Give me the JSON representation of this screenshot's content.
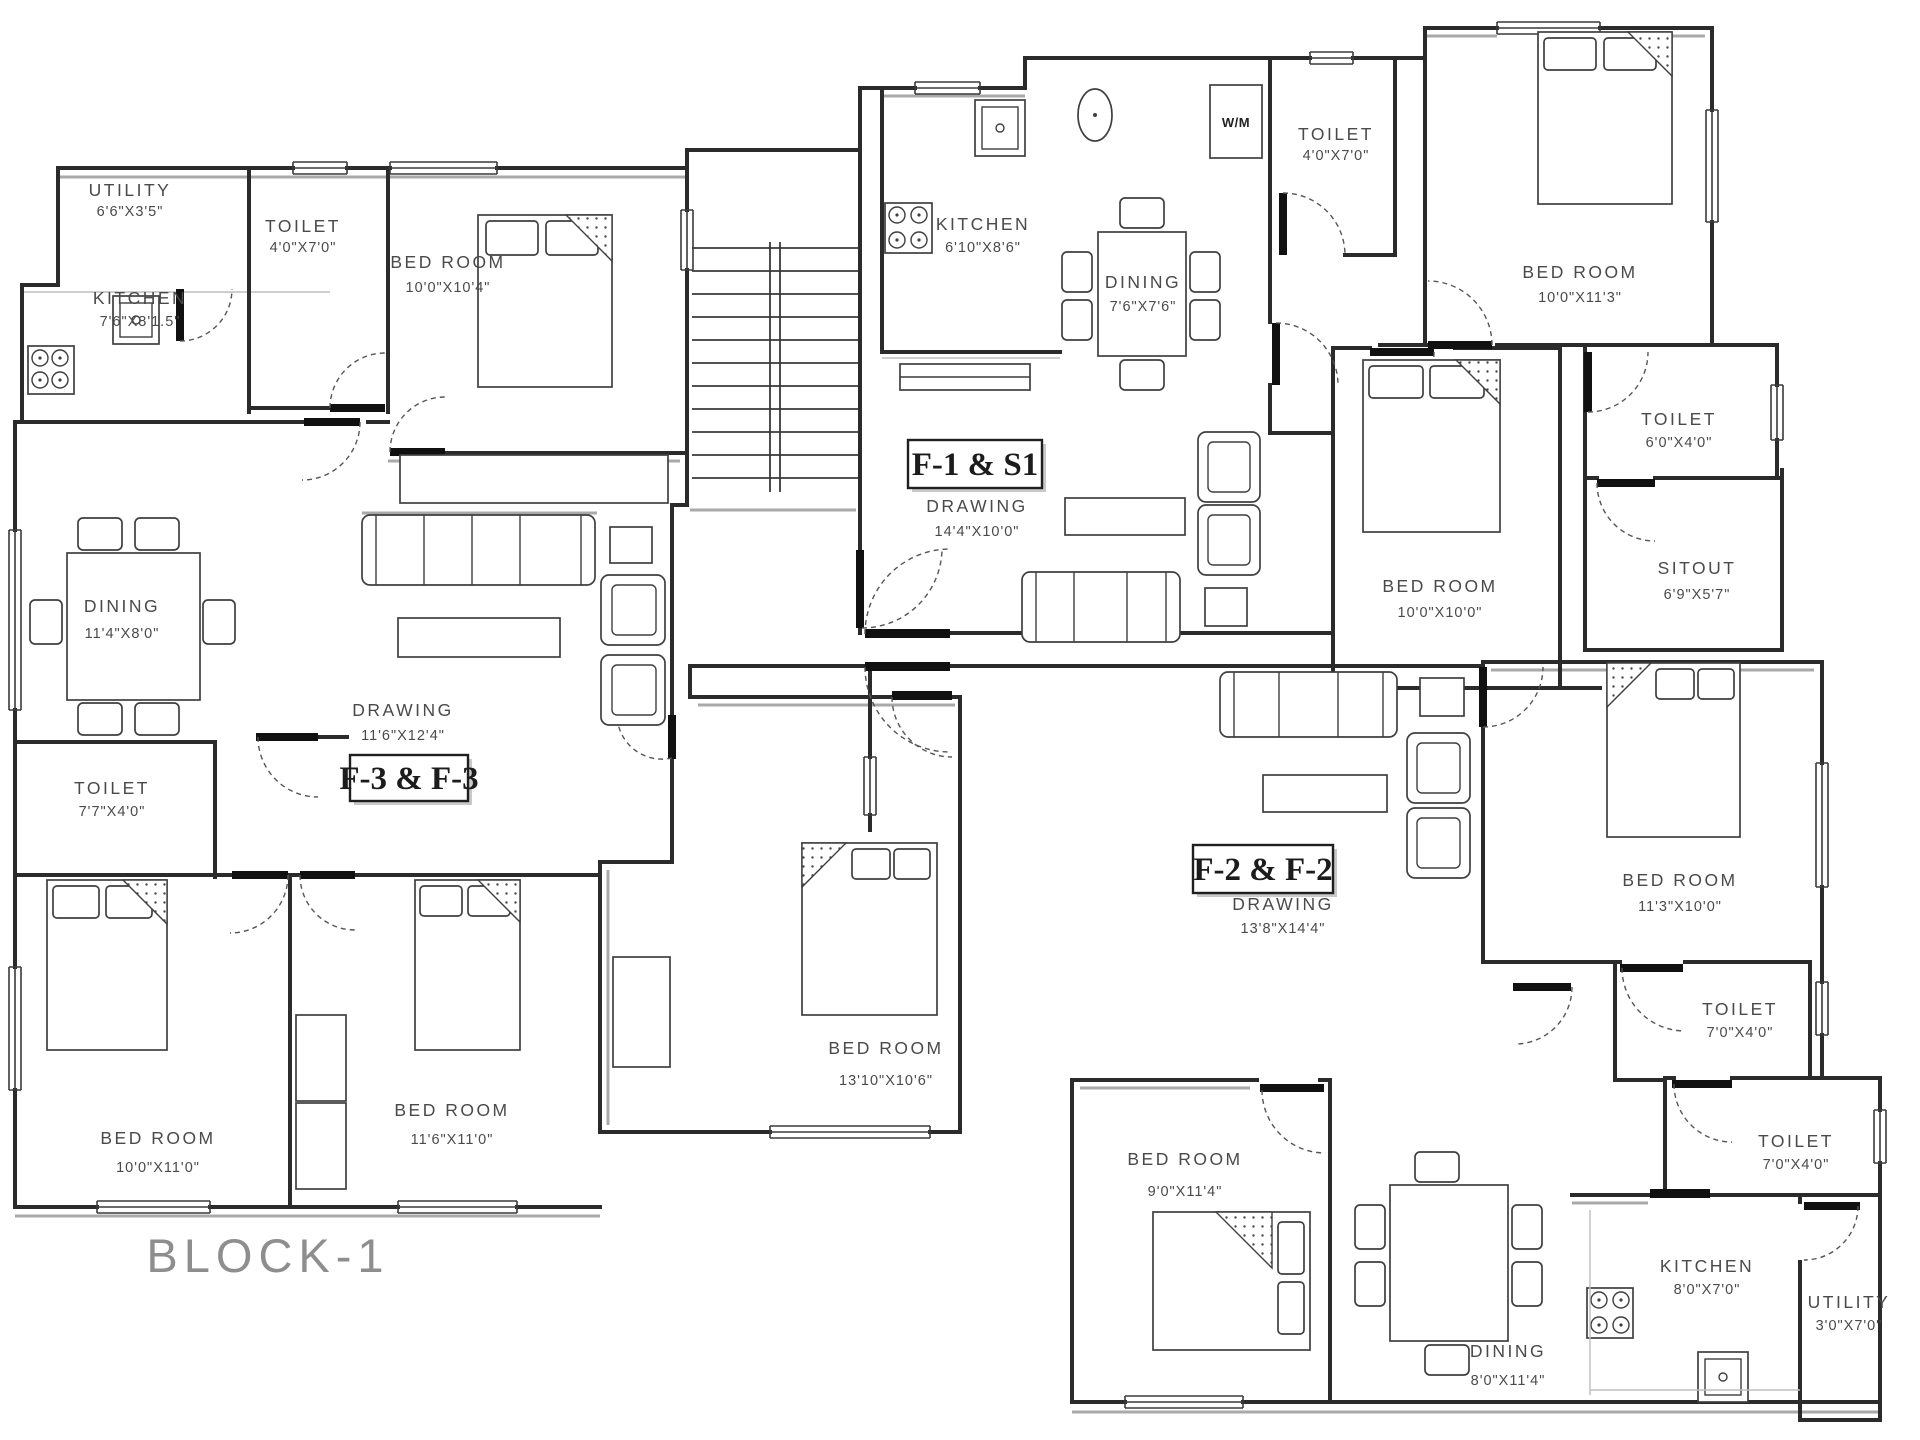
{
  "title": "BLOCK-1",
  "units": [
    {
      "label": "F-3 & F-3"
    },
    {
      "label": "F-1 & S1"
    },
    {
      "label": "F-2 & F-2"
    }
  ],
  "rooms": [
    {
      "name": "UTILITY",
      "dims": "6'6\"X3'5\""
    },
    {
      "name": "TOILET",
      "dims": "4'0\"X7'0\""
    },
    {
      "name": "BED ROOM",
      "dims": "10'0\"X10'4\""
    },
    {
      "name": "KITCHEN",
      "dims": "7'6\"X8'1.5\""
    },
    {
      "name": "DINING",
      "dims": "11'4\"X8'0\""
    },
    {
      "name": "DRAWING",
      "dims": "11'6\"X12'4\""
    },
    {
      "name": "TOILET",
      "dims": "7'7\"X4'0\""
    },
    {
      "name": "BED ROOM",
      "dims": "10'0\"X11'0\""
    },
    {
      "name": "BED ROOM",
      "dims": "11'6\"X11'0\""
    },
    {
      "name": "KITCHEN",
      "dims": "6'10\"X8'6\""
    },
    {
      "name": "DINING",
      "dims": "7'6\"X7'6\""
    },
    {
      "name": "TOILET",
      "dims": "4'0\"X7'0\""
    },
    {
      "name": "W/M",
      "dims": ""
    },
    {
      "name": "BED ROOM",
      "dims": "10'0\"X11'3\""
    },
    {
      "name": "DRAWING",
      "dims": "14'4\"X10'0\""
    },
    {
      "name": "BED ROOM",
      "dims": "10'0\"X10'0\""
    },
    {
      "name": "TOILET",
      "dims": "6'0\"X4'0\""
    },
    {
      "name": "SITOUT",
      "dims": "6'9\"X5'7\""
    },
    {
      "name": "DRAWING",
      "dims": "13'8\"X14'4\""
    },
    {
      "name": "BED ROOM",
      "dims": "11'3\"X10'0\""
    },
    {
      "name": "TOILET",
      "dims": "7'0\"X4'0\""
    },
    {
      "name": "TOILET",
      "dims": "7'0\"X4'0\""
    },
    {
      "name": "BED ROOM",
      "dims": "13'10\"X10'6\""
    },
    {
      "name": "BED ROOM",
      "dims": "9'0\"X11'4\""
    },
    {
      "name": "DINING",
      "dims": "8'0\"X11'4\""
    },
    {
      "name": "KITCHEN",
      "dims": "8'0\"X7'0\""
    },
    {
      "name": "UTILITY",
      "dims": "3'0\"X7'0\""
    }
  ]
}
